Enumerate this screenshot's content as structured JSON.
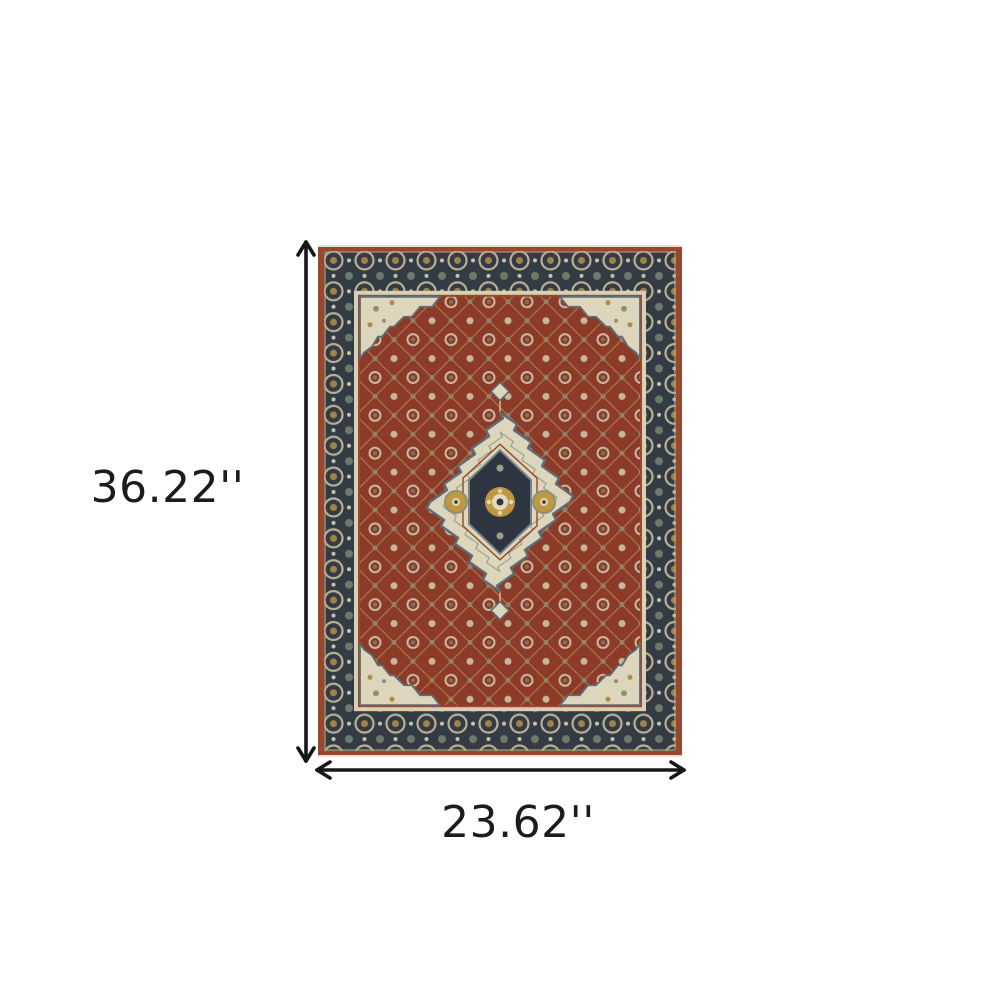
{
  "scene": {
    "background_color": "#ffffff",
    "description": "Product dimension diagram of a red and navy oriental medallion area rug"
  },
  "product": {
    "name": "oriental-area-rug",
    "description": "Red and blue traditional oriental rug with ivory central medallion, corner spandrels and dark floral border",
    "colors": {
      "edge_rust": "#9a4730",
      "border_navy": "#333b45",
      "field_red": "#8b3b27",
      "ivory": "#ddd6bd",
      "gold": "#bf9941",
      "sage": "#8e9077",
      "guard_tan": "#d8d1b6",
      "medallion_navy": "#2e3440"
    }
  },
  "dimensions": {
    "height": {
      "label": "36.22''"
    },
    "width": {
      "label": "23.62''"
    },
    "arrow_color": "#161616",
    "label_color": "#1c1c1c"
  }
}
